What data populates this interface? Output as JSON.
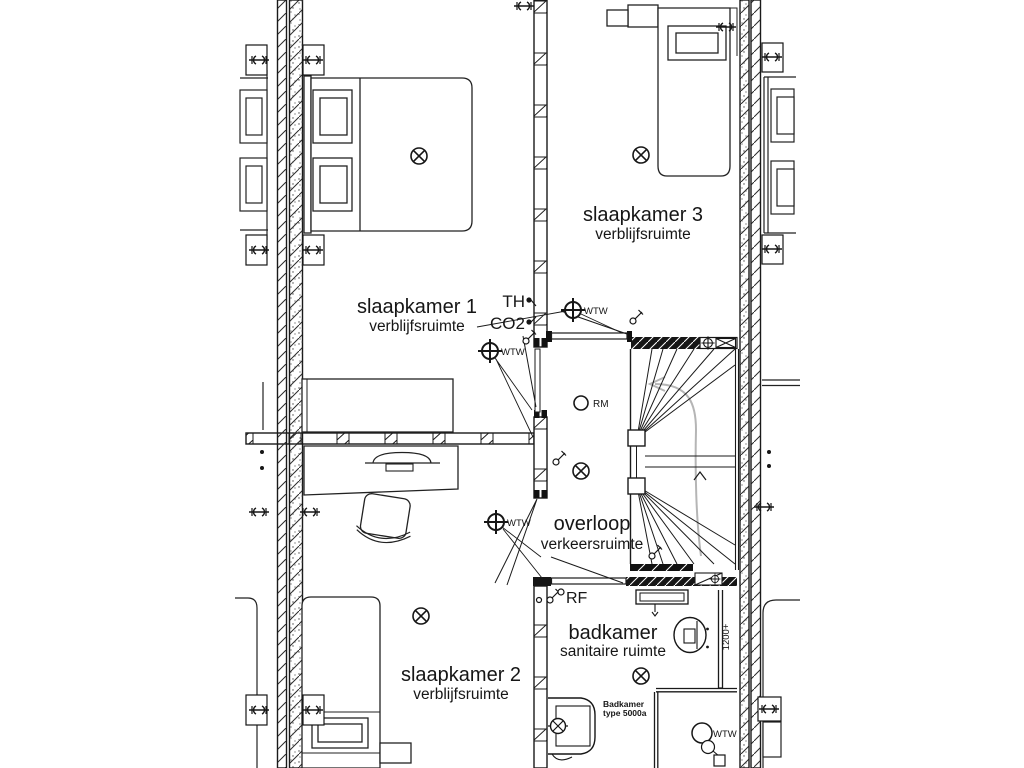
{
  "drawing": {
    "title": "floor plan upper storey",
    "rooms": [
      {
        "name": "slaapkamer 1",
        "subtitle": "verblijfsruimte"
      },
      {
        "name": "slaapkamer 2",
        "subtitle": "verblijfsruimte"
      },
      {
        "name": "slaapkamer 3",
        "subtitle": "verblijfsruimte"
      },
      {
        "name": "overloop",
        "subtitle": "verkeersruimte"
      },
      {
        "name": "badkamer",
        "subtitle": "sanitaire ruimte"
      }
    ],
    "annotations": {
      "thermostat": "TH",
      "co2": "CO2",
      "wtw": "WTW",
      "smoke_detector": "RM",
      "rf": "RF",
      "height_marker": "1200+",
      "bath_label_line1": "Badkamer",
      "bath_label_line2": "type 5000a"
    },
    "colors": {
      "line": "#1a1a1a",
      "walk_arrow": "#b5b5b5",
      "background": "#ffffff"
    }
  }
}
